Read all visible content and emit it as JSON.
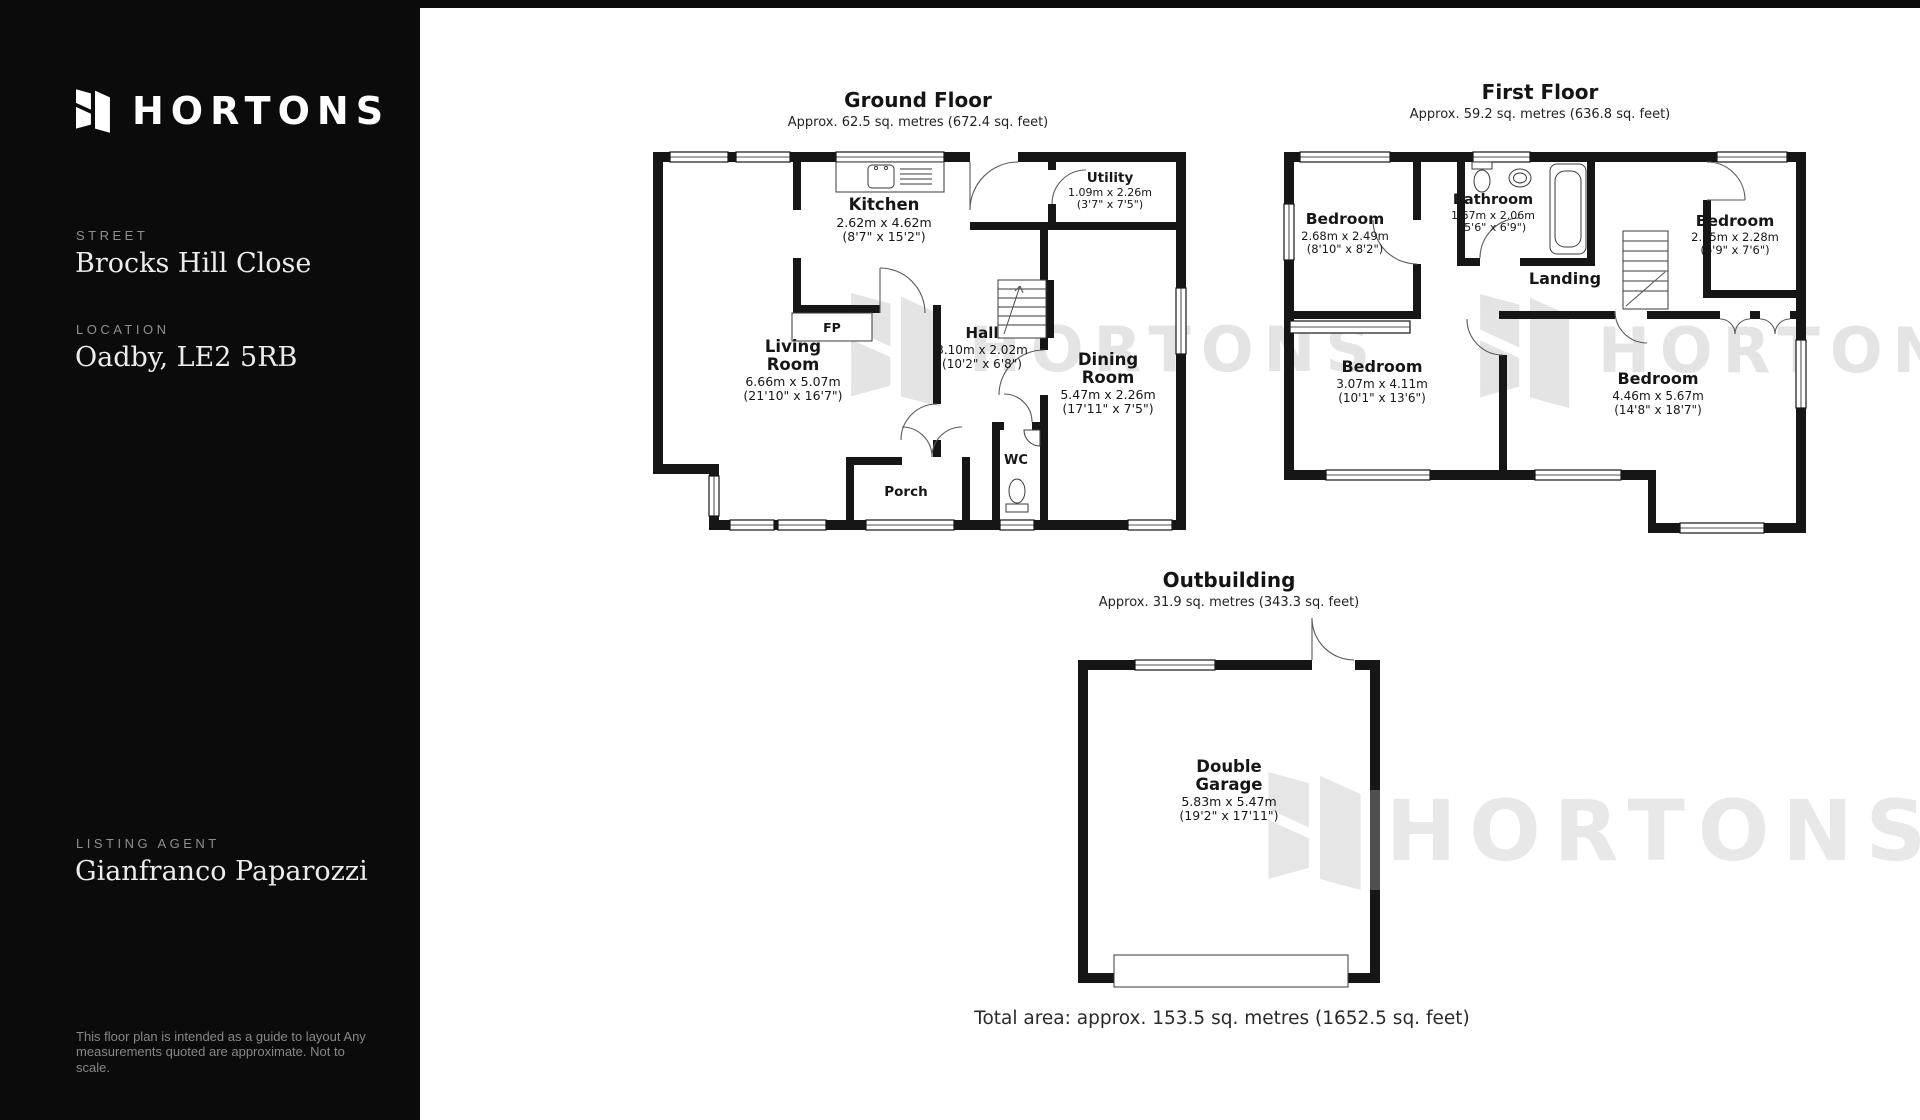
{
  "colors": {
    "sidebar_bg": "#0b0b0b",
    "wall": "#161616",
    "watermark": "#e4e4e4"
  },
  "watermark": {
    "text": "HORTONS"
  },
  "sidebar": {
    "brand": "HORTONS",
    "street_label": "STREET",
    "street_value": "Brocks Hill Close",
    "location_label": "LOCATION",
    "location_value": "Oadby, LE2 5RB",
    "agent_label": "LISTING AGENT",
    "agent_value": "Gianfranco Paparozzi",
    "disclaimer_line1": "This floor plan is intended  as a guide to layout Any",
    "disclaimer_line2": "measurements quoted are approximate. Not to scale."
  },
  "plans": {
    "ground_floor": {
      "title": "Ground Floor",
      "area": "Approx. 62.5 sq. metres (672.4 sq. feet)",
      "rooms": {
        "kitchen": {
          "name": "Kitchen",
          "metric": "2.62m x 4.62m",
          "imperial": "(8'7\" x 15'2\")"
        },
        "utility": {
          "name": "Utility",
          "metric": "1.09m x 2.26m",
          "imperial": "(3'7\" x 7'5\")"
        },
        "living": {
          "name1": "Living",
          "name2": "Room",
          "metric": "6.66m x 5.07m",
          "imperial": "(21'10\" x 16'7\")"
        },
        "hall": {
          "name": "Hall",
          "metric": "3.10m x 2.02m",
          "imperial": "(10'2\" x 6'8\")"
        },
        "dining": {
          "name1": "Dining",
          "name2": "Room",
          "metric": "5.47m x 2.26m",
          "imperial": "(17'11\" x 7'5\")"
        },
        "porch": {
          "name": "Porch"
        },
        "wc": {
          "name": "WC"
        },
        "fireplace": {
          "name": "FP"
        }
      }
    },
    "first_floor": {
      "title": "First Floor",
      "area": "Approx. 59.2 sq. metres (636.8 sq. feet)",
      "rooms": {
        "bedroom_tl": {
          "name": "Bedroom",
          "metric": "2.68m x 2.49m",
          "imperial": "(8'10\" x 8'2\")"
        },
        "bathroom": {
          "name": "Bathroom",
          "metric": "1.67m x 2.06m",
          "imperial": "(5'6\" x 6'9\")"
        },
        "bedroom_tr": {
          "name": "Bedroom",
          "metric": "2.05m x 2.28m",
          "imperial": "(6'9\" x 7'6\")"
        },
        "landing": {
          "name": "Landing"
        },
        "bedroom_bl": {
          "name": "Bedroom",
          "metric": "3.07m x 4.11m",
          "imperial": "(10'1\" x 13'6\")"
        },
        "bedroom_br": {
          "name": "Bedroom",
          "metric": "4.46m x 5.67m",
          "imperial": "(14'8\" x 18'7\")"
        }
      }
    },
    "outbuilding": {
      "title": "Outbuilding",
      "area": "Approx. 31.9 sq. metres (343.3 sq. feet)",
      "rooms": {
        "garage": {
          "name1": "Double",
          "name2": "Garage",
          "metric": "5.83m x 5.47m",
          "imperial": "(19'2\" x 17'11\")"
        }
      }
    },
    "total_area": "Total area: approx. 153.5 sq. metres (1652.5 sq. feet)"
  }
}
